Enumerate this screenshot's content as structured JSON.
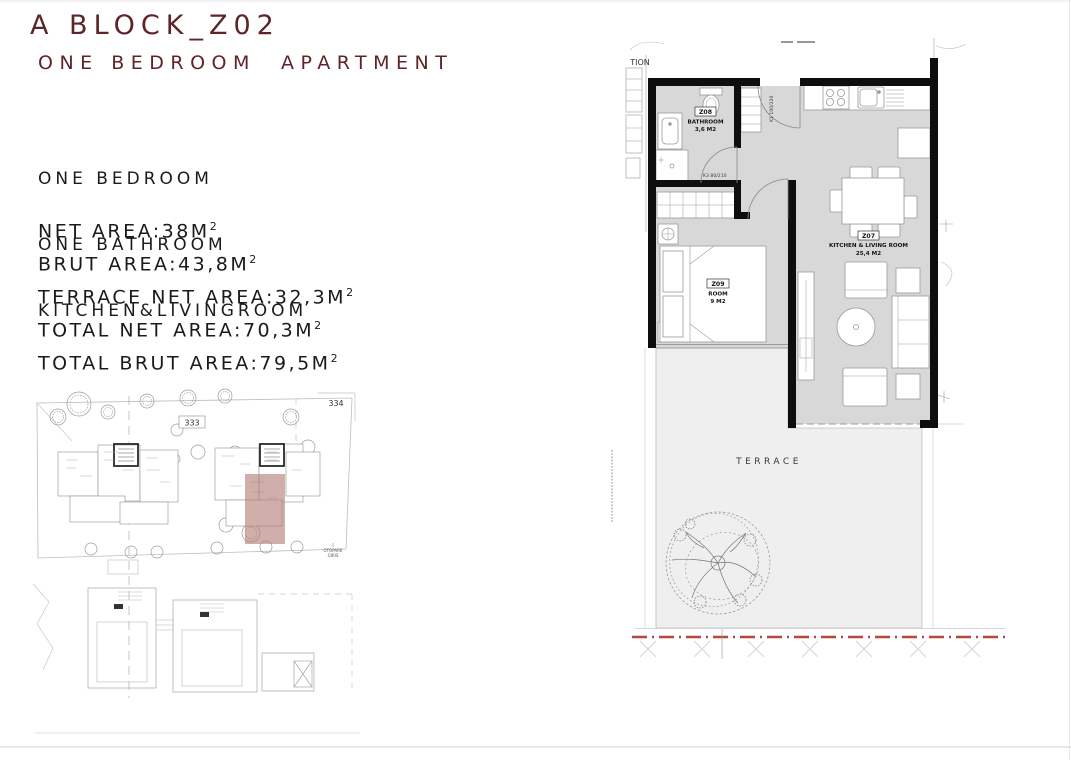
{
  "header": {
    "title": "A BLOCK_Z02",
    "subtitle": "ONE BEDROOM  APARTMENT"
  },
  "description": {
    "lines": [
      "ONE BEDROOM",
      "ONE BATHROOM",
      "KITCHEN&LIVINGROOM"
    ]
  },
  "areas": {
    "rows": [
      {
        "text": "NET AREA:38M",
        "sup": "2"
      },
      {
        "text": "BRUT AREA:43,8M",
        "sup": "2"
      },
      {
        "text": "TERRACE NET AREA:32,3M",
        "sup": "2"
      },
      {
        "text": "TOTAL NET AREA:70,3M",
        "sup": "2"
      },
      {
        "text": "TOTAL BRUT AREA:79,5M",
        "sup": "2"
      }
    ]
  },
  "site_plan": {
    "labels": {
      "parcel_334": "334",
      "parcel_333": "333",
      "parking_line1": "OTOPARK",
      "parking_line2": "GIRIS"
    },
    "highlight_color": "#b07a73"
  },
  "floor_plan": {
    "rooms": {
      "bathroom": {
        "code": "Z08",
        "name": "BATHROOM",
        "area": "3,6 M2"
      },
      "bedroom": {
        "code": "Z09",
        "name": "ROOM",
        "area": "9 M2"
      },
      "living": {
        "code": "Z07",
        "name": "KITCHEN & LIVING ROOM",
        "area": "25,4 M2"
      }
    },
    "doors": {
      "bathroom": "K3 80/210",
      "entry": "K1 100/220"
    },
    "terrace_label": "TERRACE",
    "adjacent_text": "TION",
    "colors": {
      "floor": "#d8d8d8",
      "terrace": "#efefef",
      "wall": "#0e0e0e",
      "property_line": "#b5473c",
      "title": "#5e2428"
    }
  }
}
